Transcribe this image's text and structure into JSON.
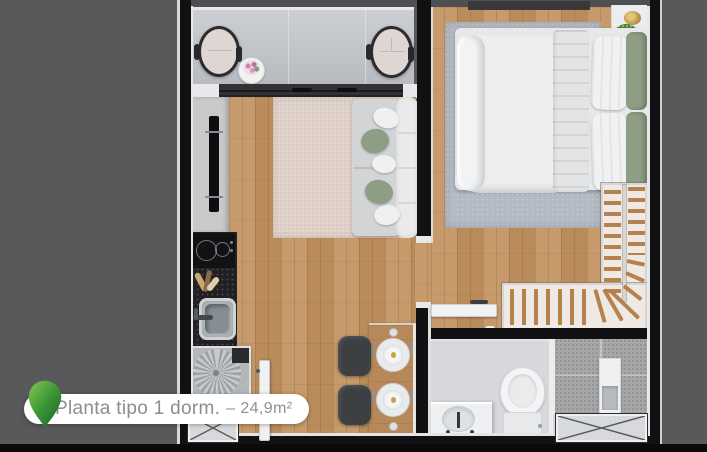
{
  "label": {
    "title": "Planta tipo 1 dorm.",
    "area": "– 24,9m²"
  },
  "colors": {
    "background_gray": "#59595b",
    "bottom_band_black": "#0a0a0a",
    "wall_black": "#111113",
    "trim_white": "#e8e8ea",
    "wood_floor": "#c2925f",
    "balcony_floor": "#c4c8cc",
    "living_rug": "#ddcec5",
    "bedroom_rug": "#b3bac3",
    "sofa_gray": "#d2d4d6",
    "pillow_green": "#8d9e85",
    "stair_tread_wood": "#b5814f",
    "shower_tile": "#a5a7a9",
    "pill_background": "#ffffff",
    "label_text": "#8d8d90",
    "pin_green_light": "#82c94d",
    "pin_green_dark": "#14632a"
  }
}
